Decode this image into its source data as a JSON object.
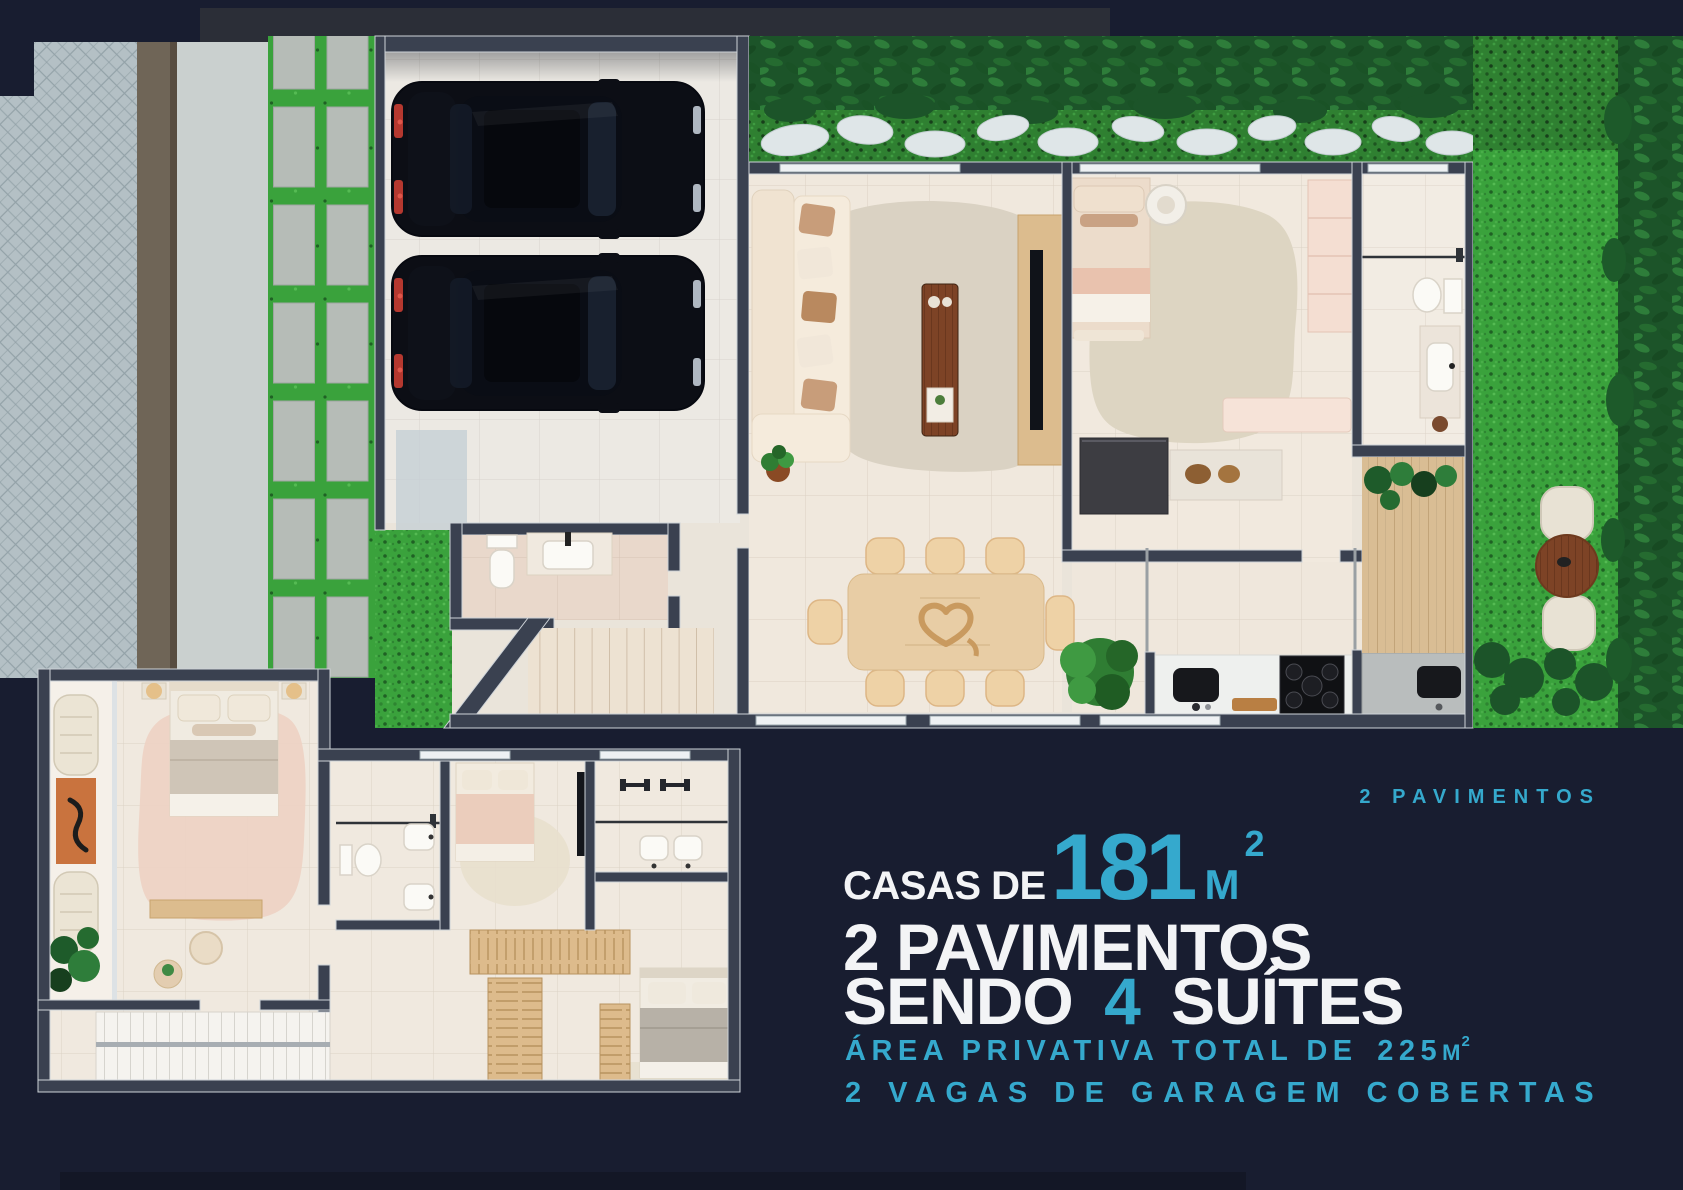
{
  "palette": {
    "background": "#181d30",
    "accent_cyan": "#35a9cd",
    "text_white": "#f3f4f6",
    "grass_green": "#3aa23c",
    "wall_dark": "#3a4150",
    "floor_beige": "#efe7dc"
  },
  "headline": {
    "tag": "2 PAVIMENTOS",
    "prefix": "CASAS DE",
    "area_value": "181",
    "area_unit": "M",
    "area_exp": "2",
    "floors_line": "2 PAVIMENTOS",
    "suites_prefix": "SENDO",
    "suites_value": "4",
    "suites_suffix": "SUÍTES",
    "private_label": "ÁREA PRIVATIVA TOTAL DE",
    "private_value": "225",
    "private_unit": "M",
    "private_exp": "2",
    "garage_line": "2 VAGAS DE GARAGEM COBERTAS"
  }
}
